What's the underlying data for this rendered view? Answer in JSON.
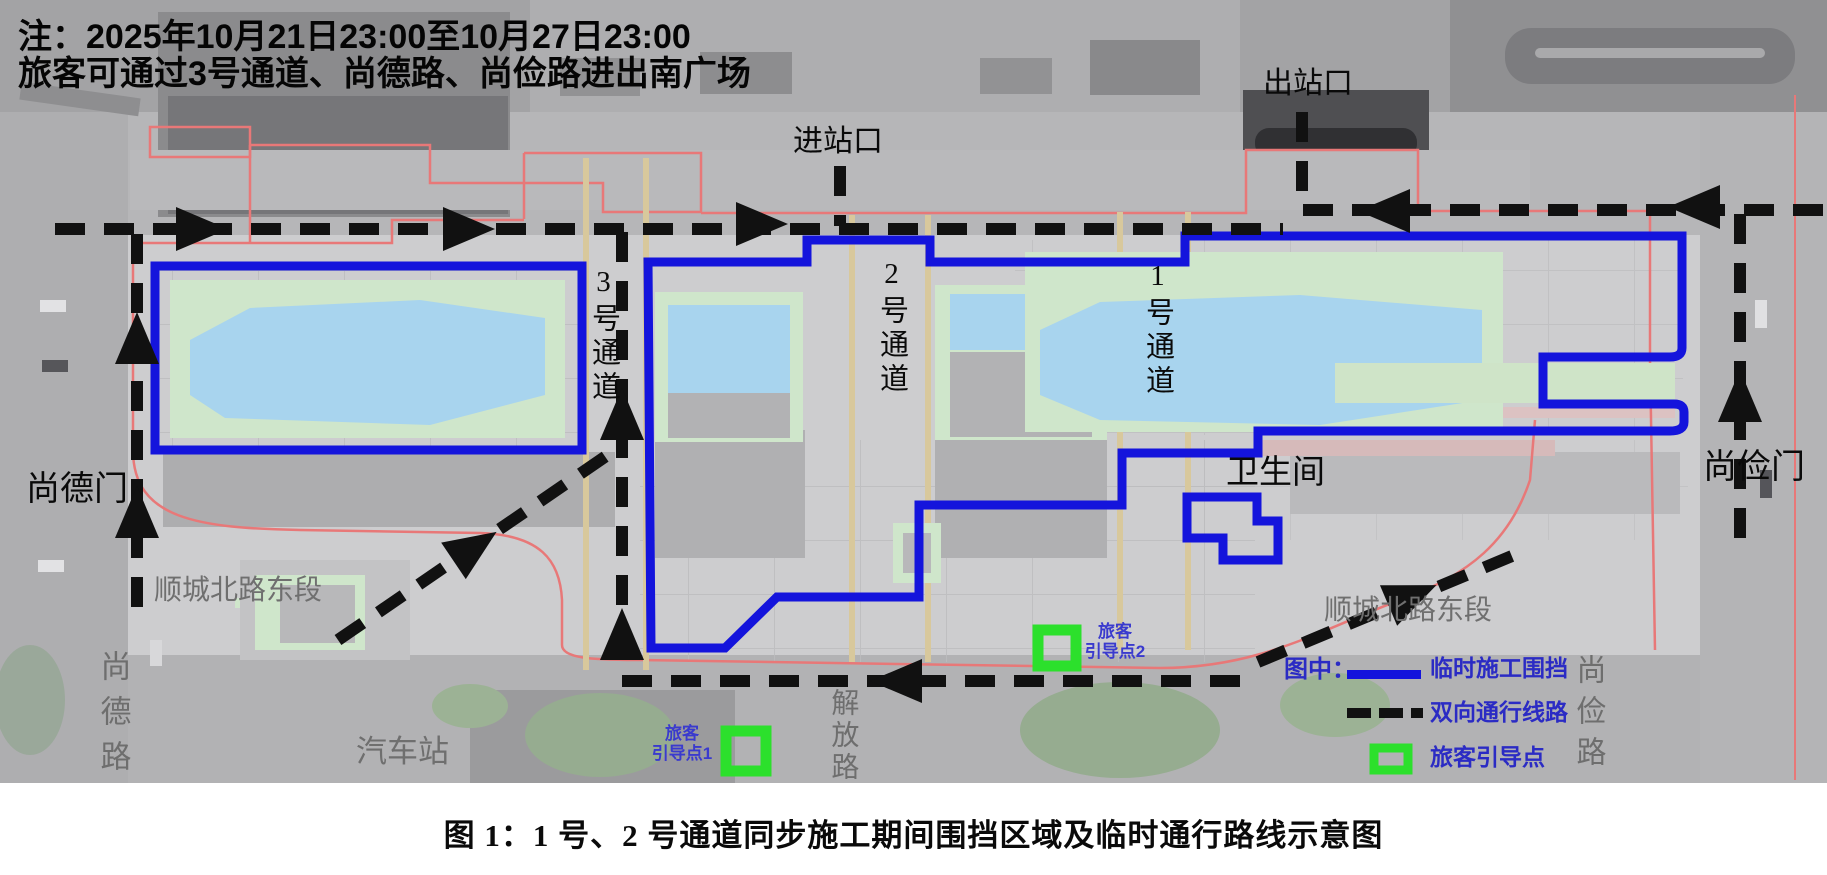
{
  "note": {
    "line1": "注：2025年10月21日23:00至10月27日23:00",
    "line2": "旅客可通过3号通道、尚德路、尚俭路进出南广场"
  },
  "gates": {
    "entrance": "进站口",
    "exit": "出站口",
    "shangde_gate": "尚德门",
    "shangjian_gate": "尚俭门"
  },
  "channels": {
    "ch1": "1号通道",
    "ch2": "2号通道",
    "ch3": "3号通道"
  },
  "streets": {
    "shuncheng_left": "顺城北路东段",
    "shuncheng_right": "顺城北路东段",
    "shangde_road": "尚德路",
    "shangjian_road": "尚俭路",
    "jiefang_road": "解放路",
    "bus_station": "汽车站"
  },
  "places": {
    "restroom": "卫生间"
  },
  "guide_points": {
    "p1_line1": "旅客",
    "p1_line2": "引导点1",
    "p2_line1": "旅客",
    "p2_line2": "引导点2"
  },
  "legend": {
    "title": "图中：",
    "items": [
      {
        "label": "临时施工围挡",
        "symbol": "blue-solid-line"
      },
      {
        "label": "双向通行线路",
        "symbol": "black-dashed-line"
      },
      {
        "label": "旅客引导点",
        "symbol": "green-square"
      }
    ]
  },
  "caption": "图 1：1 号、2 号通道同步施工期间围挡区域及临时通行路线示意图",
  "colors": {
    "fence_blue": "#1414dc",
    "route_black": "#111111",
    "guide_green": "#2ce02c",
    "legend_blue": "#2b2bc4",
    "boundary_red": "#e87878"
  }
}
